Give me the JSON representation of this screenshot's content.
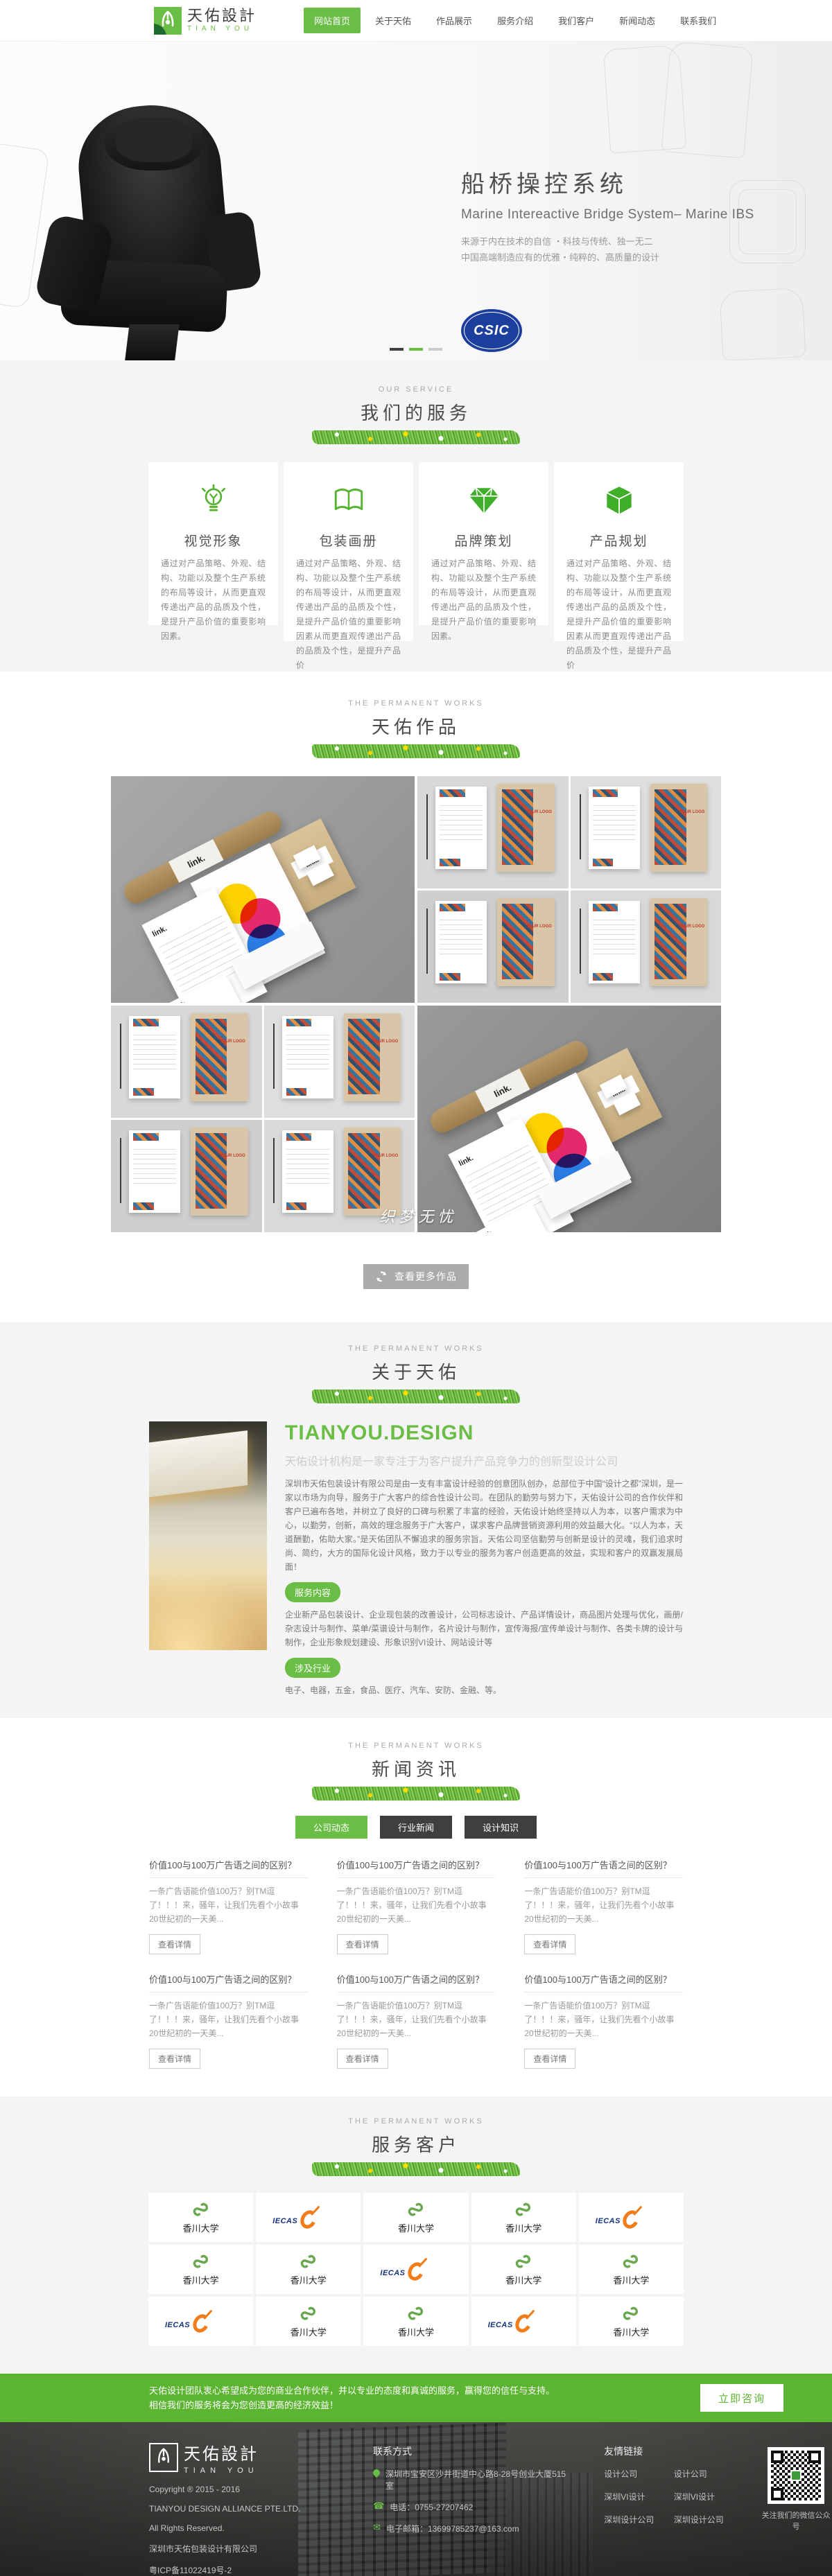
{
  "header": {
    "logo_cn": "天佑設計",
    "logo_en": "TIAN YOU",
    "nav": [
      {
        "label": "网站首页",
        "active": true
      },
      {
        "label": "关于天佑",
        "active": false
      },
      {
        "label": "作品展示",
        "active": false
      },
      {
        "label": "服务介绍",
        "active": false
      },
      {
        "label": "我们客户",
        "active": false
      },
      {
        "label": "新闻动态",
        "active": false
      },
      {
        "label": "联系我们",
        "active": false
      }
    ]
  },
  "hero": {
    "title": "船桥操控系统",
    "subtitle": "Marine Intereactive Bridge System– Marine IBS",
    "line1": "来源于内在技术的自信 ・科技与传统、独一无二",
    "line2": "中国高端制造应有的优雅・纯粹的、高质量的设计",
    "csic": "CSIC"
  },
  "services": {
    "eyebrow": "OUR SERVICE",
    "title": "我们的服务",
    "cards": [
      {
        "title": "视觉形象",
        "text": "通过对产品策略、外观、结构、功能以及整个生产系统的布局等设计，从而更直观传递出产品的品质及个性，是提升产品价值的重要影响因素。"
      },
      {
        "title": "包装画册",
        "text": "通过对产品策略、外观、结构、功能以及整个生产系统的布局等设计，从而更直观传递出产品的品质及个性，是提升产品价值的重要影响因素从而更直观传递出产品的品质及个性，是提升产品价"
      },
      {
        "title": "品牌策划",
        "text": "通过对产品策略、外观、结构、功能以及整个生产系统的布局等设计，从而更直观传递出产品的品质及个性，是提升产品价值的重要影响因素。"
      },
      {
        "title": "产品规划",
        "text": "通过对产品策略、外观、结构、功能以及整个生产系统的布局等设计，从而更直观传递出产品的品质及个性，是提升产品价值的重要影响因素从而更直观传递出产品的品质及个性，是提升产品价"
      }
    ]
  },
  "works": {
    "eyebrow": "THE PERMANENT WORKS",
    "title": "天佑作品",
    "brand": "link.",
    "brochure_text": "YOUR LOGO",
    "watermark": "织梦无忧",
    "more": "查看更多作品"
  },
  "about": {
    "eyebrow": "THE PERMANENT WORKS",
    "title": "关于天佑",
    "heading": "TIANYOU.DESIGN",
    "subheading": "天佑设计机构是一家专注于为客户提升产品竞争力的创新型设计公司",
    "body": "深圳市天佑包装设计有限公司是由一支有丰富设计经验的创意团队创办，总部位于中国“设计之都”深圳，是一家以市场为向导，服务于广大客户的综合性设计公司。在团队的勤劳与努力下，天佑设计公司的合作伙伴和客户已遍布各地，并树立了良好的口碑与积累了丰富的经验，天佑设计始终坚持以人为本，以客户需求为中心，以勤劳，创新，高效的理念服务于广大客户，谋求客户品牌营销资源利用的效益最大化。“以人为本，天道酬勤，佑助大家。”是天佑团队不懈追求的服务宗旨。天佑公司坚信勤劳与创新是设计的灵魂，我们追求时尚、简约，大方的国际化设计风格，致力于以专业的服务为客户创造更高的效益，实现和客户的双赢发展局面！",
    "tags": [
      {
        "label": "服务内容",
        "text": "企业新产品包装设计、企业现包装的改善设计，公司标志设计、产品详情设计，商品图片处理与优化，画册/杂志设计与制作、菜单/菜谱设计与制作，名片设计与制作，宣传海报/宣传单设计与制作、各类卡牌的设计与制作，企业形象规划建设、形象识别VI设计、网站设计等"
      },
      {
        "label": "涉及行业",
        "text": "电子、电器，五金，食品、医疗、汽车、安防、金融、等。"
      }
    ]
  },
  "news": {
    "eyebrow": "THE PERMANENT WORKS",
    "title": "新闻资讯",
    "tabs": [
      {
        "label": "公司动态",
        "active": true
      },
      {
        "label": "行业新闻",
        "active": false
      },
      {
        "label": "设计知识",
        "active": false
      }
    ],
    "detail_label": "查看详情",
    "items": [
      {
        "title": "价值100与100万广告语之间的区别？",
        "excerpt": "一条广告语能价值100万？别TM逗了！！！来，骚年，让我们先看个小故事 20世纪初的一天美..."
      },
      {
        "title": "价值100与100万广告语之间的区别？",
        "excerpt": "一条广告语能价值100万？别TM逗了！！！来，骚年，让我们先看个小故事 20世纪初的一天美..."
      },
      {
        "title": "价值100与100万广告语之间的区别？",
        "excerpt": "一条广告语能价值100万？别TM逗了！！！来，骚年，让我们先看个小故事 20世纪初的一天美..."
      },
      {
        "title": "价值100与100万广告语之间的区别？",
        "excerpt": "一条广告语能价值100万？别TM逗了！！！来，骚年，让我们先看个小故事 20世纪初的一天美..."
      },
      {
        "title": "价值100与100万广告语之间的区别？",
        "excerpt": "一条广告语能价值100万？别TM逗了！！！来，骚年，让我们先看个小故事 20世纪初的一天美..."
      },
      {
        "title": "价值100与100万广告语之间的区别？",
        "excerpt": "一条广告语能价值100万？别TM逗了！！！来，骚年，让我们先看个小故事 20世纪初的一天美..."
      }
    ]
  },
  "clients": {
    "eyebrow": "THE PERMANENT WORKS",
    "title": "服务客户",
    "logos": [
      {
        "type": "kagawa",
        "label": "香川大学"
      },
      {
        "type": "iecas",
        "label": "IECAS"
      },
      {
        "type": "kagawa",
        "label": "香川大学"
      },
      {
        "type": "kagawa",
        "label": "香川大学"
      },
      {
        "type": "iecas",
        "label": "IECAS"
      },
      {
        "type": "kagawa",
        "label": "香川大学"
      },
      {
        "type": "kagawa",
        "label": "香川大学"
      },
      {
        "type": "iecas",
        "label": "IECAS"
      },
      {
        "type": "kagawa",
        "label": "香川大学"
      },
      {
        "type": "kagawa",
        "label": "香川大学"
      },
      {
        "type": "iecas",
        "label": "IECAS"
      },
      {
        "type": "kagawa",
        "label": "香川大学"
      },
      {
        "type": "kagawa",
        "label": "香川大学"
      },
      {
        "type": "iecas",
        "label": "IECAS"
      },
      {
        "type": "kagawa",
        "label": "香川大学"
      }
    ]
  },
  "cta": {
    "line1": "天佑设计团队衷心希望成为您的商业合作伙伴，并以专业的态度和真诚的服务，赢得您的信任与支持。",
    "line2": "相信我们的服务将会为您创造更高的经济效益！",
    "button": "立即咨询"
  },
  "footer": {
    "logo_cn": "天佑設計",
    "logo_en": "TIAN YOU",
    "copyright": "Copyright ® 2015 - 2016",
    "company_en": "TIANYOU DESIGN ALLIANCE PTE.LTD.",
    "rights": "All Rights Reserved.",
    "company_cn": "深圳市天佑包装设计有限公司",
    "icp": "粤ICP备11022419号-2",
    "contact_title": "联系方式",
    "address": "深圳市宝安区沙井街道中心路8-28号创业大厦515室",
    "phone": "电话：0755-27207462",
    "email": "电子邮箱：13699785237@163.com",
    "links_title": "友情链接",
    "links": [
      "设计公司",
      "设计公司",
      "深圳VI设计",
      "深圳VI设计",
      "深圳设计公司",
      "深圳设计公司"
    ],
    "qr_caption": "关注我们的微信公众号"
  }
}
